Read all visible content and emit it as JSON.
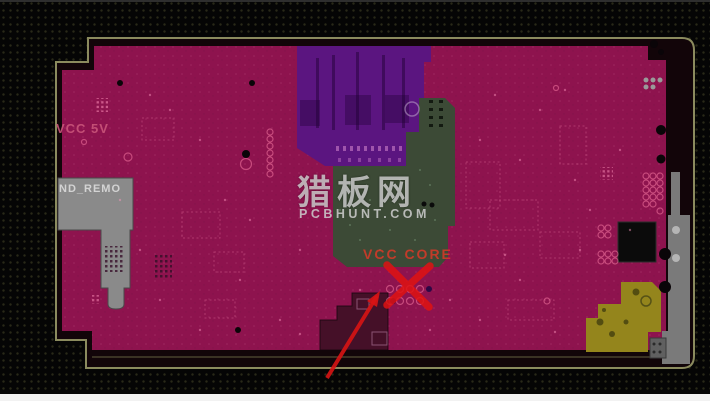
{
  "board": {
    "net_labels": {
      "vcc_5v": "VCC 5V",
      "gnd_remove": "ND_REMO",
      "vcc_core": "VCC CORE"
    },
    "colors": {
      "copper": "#8E134E",
      "purple_region": "#5B1580",
      "green_region": "#3C4A36",
      "olive_region": "#94851C",
      "gray_region": "#8A8A8A",
      "outline": "#8B8B5E",
      "annotation_red": "#DD1414",
      "background": "#060606"
    }
  },
  "watermark": {
    "site_name_cn": "猎板网",
    "site_domain": "PCBHUNT.COM"
  },
  "annotations": {
    "cross_icon": "red-x-mark",
    "arrow_icon": "red-arrow"
  }
}
